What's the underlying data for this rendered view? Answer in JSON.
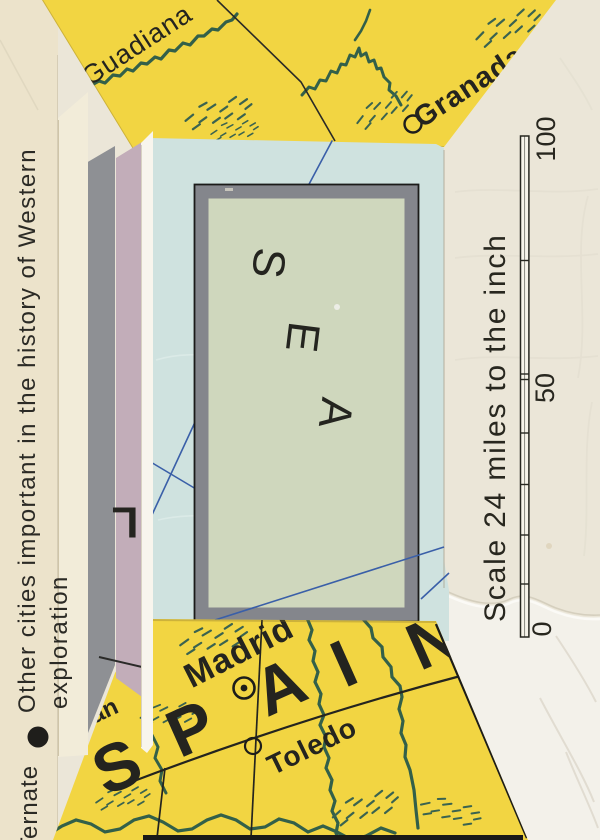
{
  "map_top": {
    "river_label": "Guadiana",
    "city_label": "Granada"
  },
  "map_bottom": {
    "country_letters": [
      "S",
      "P",
      "A",
      "I",
      "N"
    ],
    "city_primary": "Madrid",
    "city_secondary": "Toledo",
    "fragment_text": "an"
  },
  "sea_panel": {
    "letters": [
      "S",
      "E",
      "A"
    ]
  },
  "legend": {
    "line1": "Other cities important in the history of Western",
    "line2": "exploration",
    "entry": "Ternate"
  },
  "scale": {
    "caption": "Scale 24 miles to the inch",
    "max_label": "100",
    "mid_label": "50",
    "zero_label": "0"
  },
  "fragments": {
    "letter": "L"
  },
  "colors": {
    "map_yellow": "#f2d542",
    "sea_blue_paper": "#cfe2df",
    "sea_green_panel": "#cfd7bd",
    "frame_gray": "#84868c",
    "strip_gray": "#8e9094",
    "strip_lavender": "#c2adb9",
    "paper_cream": "#ebe6d8",
    "river_green": "#336049",
    "line_blue": "#3a5fa8",
    "ink_black": "#24241f"
  }
}
